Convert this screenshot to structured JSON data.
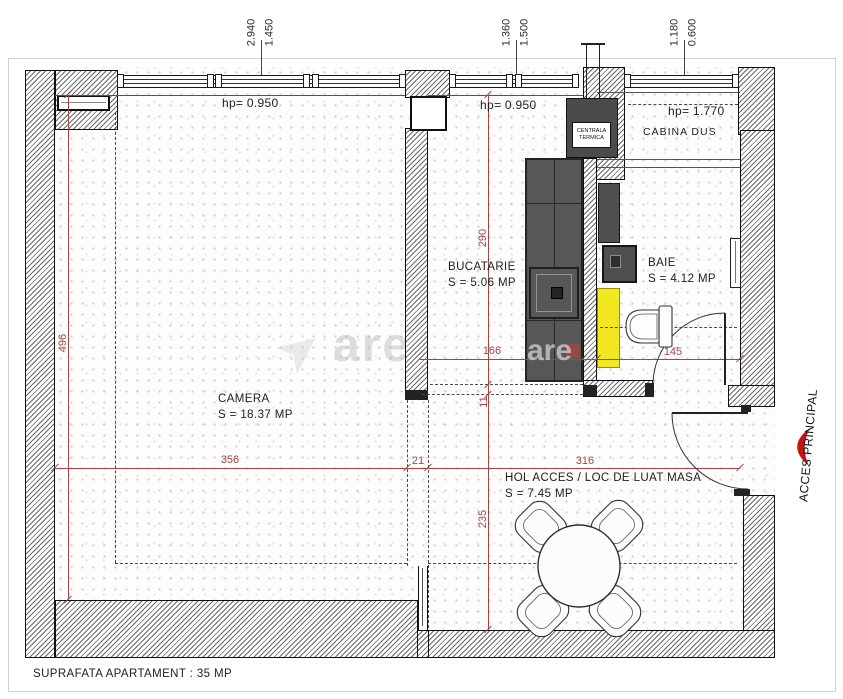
{
  "drawing": {
    "footer": "SUPRAFATA APARTAMENT : 35 MP",
    "entrance_label": "ACCES PRINCIPAL",
    "watermark": "are"
  },
  "rooms": {
    "camera": {
      "name": "CAMERA",
      "area": "S = 18.37 MP"
    },
    "bucatarie": {
      "name": "BUCATARIE",
      "area": "S = 5.06 MP"
    },
    "baie": {
      "name": "BAIE",
      "area": "S = 4.12 MP"
    },
    "cabina_dus": {
      "name": "CABINA DUS"
    },
    "hol": {
      "name": "HOL ACCES / LOC DE LUAT MASA",
      "area": "S = 7.45 MP"
    },
    "centrala": {
      "line1": "CENTRALA",
      "line2": "TERMICA"
    }
  },
  "hp": {
    "camera": "hp= 0.950",
    "bucatarie": "hp= 0.950",
    "cabina_dus": "hp= 1.770"
  },
  "dims_top": {
    "w1a": "2.940",
    "w1b": "1.450",
    "w2a": "1.360",
    "w2b": "1.500",
    "w3a": "1.180",
    "w3b": "0.600"
  },
  "dims_red": {
    "v_camera": "496",
    "h_camera": "356",
    "h_wall": "21",
    "h_hol": "316",
    "v_kitchen": "290",
    "v_step": "11",
    "v_hol": "235",
    "h_kitchen": "166",
    "h_baie": "145"
  },
  "colors": {
    "dim_red": "#a34545",
    "accent_red": "#c41414",
    "counter_gray": "#575757",
    "sink_yellow": "#f2e822"
  }
}
